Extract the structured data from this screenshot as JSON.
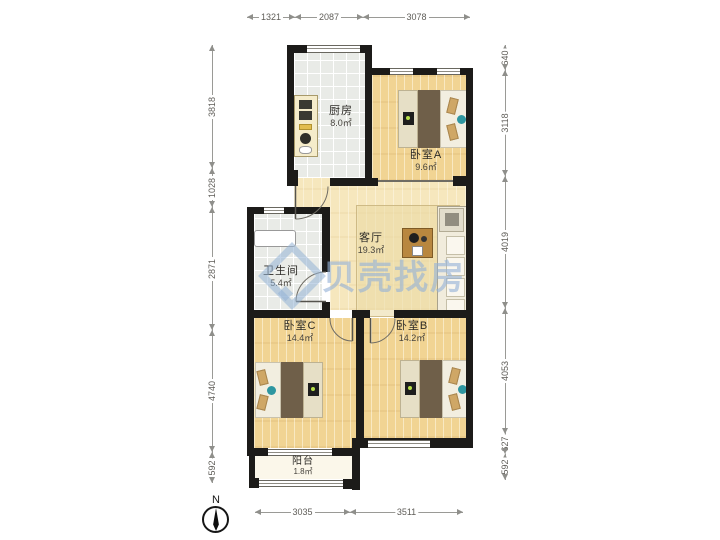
{
  "watermark": {
    "text": "贝壳找房",
    "color": "#94b2d6"
  },
  "compass": {
    "label": "N"
  },
  "rooms": {
    "kitchen": {
      "name": "厨房",
      "area": "8.0㎡"
    },
    "bedroomA": {
      "name": "卧室A",
      "area": "9.6㎡"
    },
    "living": {
      "name": "客厅",
      "area": "19.3㎡"
    },
    "bath": {
      "name": "卫生间",
      "area": "5.4㎡"
    },
    "bedroomC": {
      "name": "卧室C",
      "area": "14.4㎡"
    },
    "bedroomB": {
      "name": "卧室B",
      "area": "14.2㎡"
    },
    "balcony": {
      "name": "阳台",
      "area": "1.8㎡"
    }
  },
  "dimensions": {
    "top": [
      "1321",
      "2087",
      "3078"
    ],
    "bottom": [
      "3035",
      "3511"
    ],
    "left": [
      "3818",
      "1028",
      "2871",
      "4740",
      "592"
    ],
    "right": [
      "640",
      "3118",
      "4019",
      "4053",
      "627",
      "592"
    ]
  }
}
